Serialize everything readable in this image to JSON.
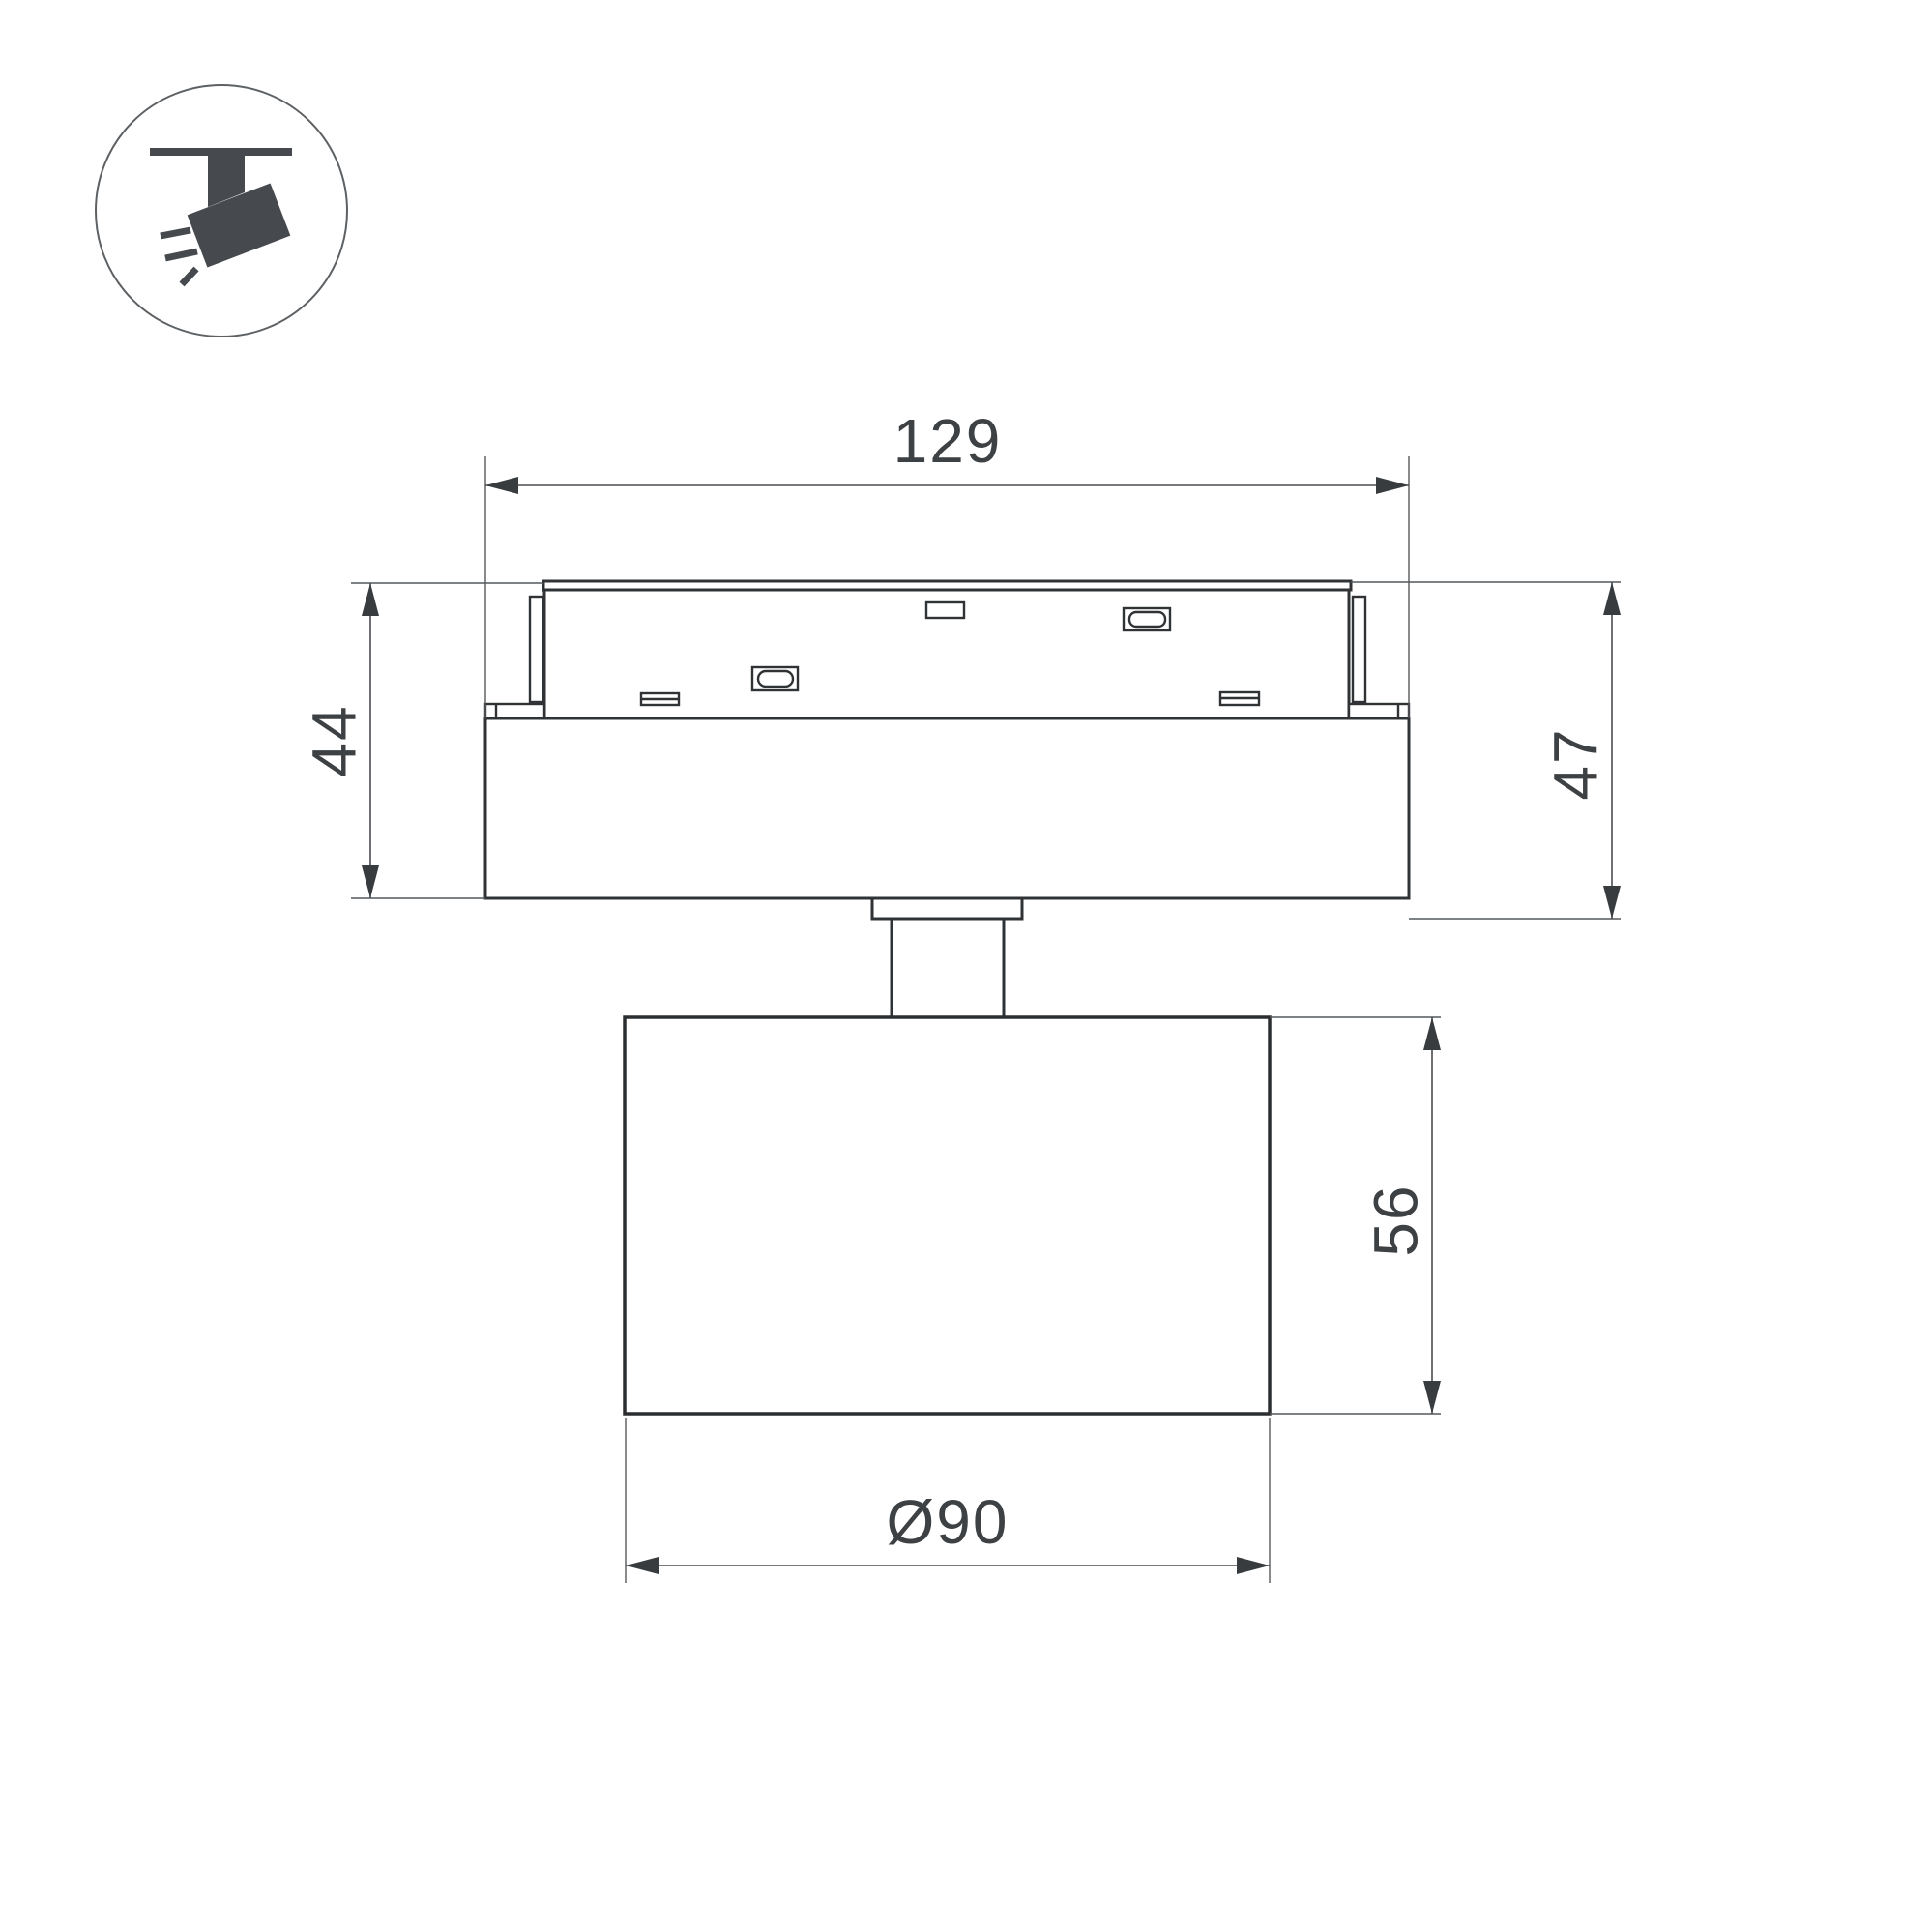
{
  "drawing": {
    "type": "technical-dimension-drawing",
    "subject": "track-mounted-spotlight-front-view",
    "background_color": "#ffffff",
    "outline_color": "#303336",
    "dimension_line_color": "#4a4d50",
    "text_color": "#3e4144",
    "icon": {
      "name": "track-spotlight-icon",
      "description": "ceiling track with tilted spotlight head and light rays",
      "color": "#46494d"
    },
    "dimensions": {
      "adapter_width": "129",
      "adapter_height": "44",
      "overall_mount_height": "47",
      "head_height": "56",
      "head_diameter": "Ø90"
    }
  }
}
